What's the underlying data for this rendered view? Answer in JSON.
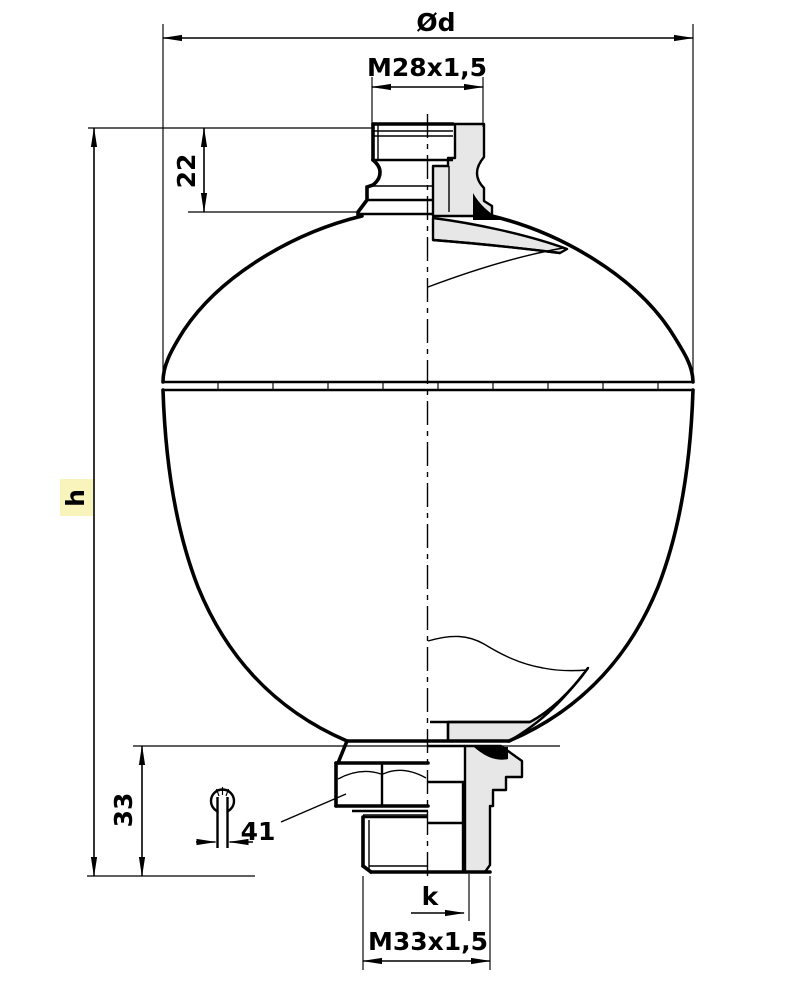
{
  "drawing": {
    "type": "technical-dimension-drawing",
    "subject": "diaphragm-accumulator-half-section",
    "labels": {
      "diameter": "Ød",
      "top_thread": "M28x1,5",
      "top_port_height": "22",
      "overall_height": "h",
      "bottom_port_height": "33",
      "wrench_size": "41",
      "spigot_length": "k",
      "bottom_thread": "M33x1,5"
    },
    "colors": {
      "line": "#000000",
      "section_fill": "#e7e7e7",
      "weld_fill": "#000000",
      "background": "#ffffff",
      "highlight": "#f8f2b0"
    }
  }
}
